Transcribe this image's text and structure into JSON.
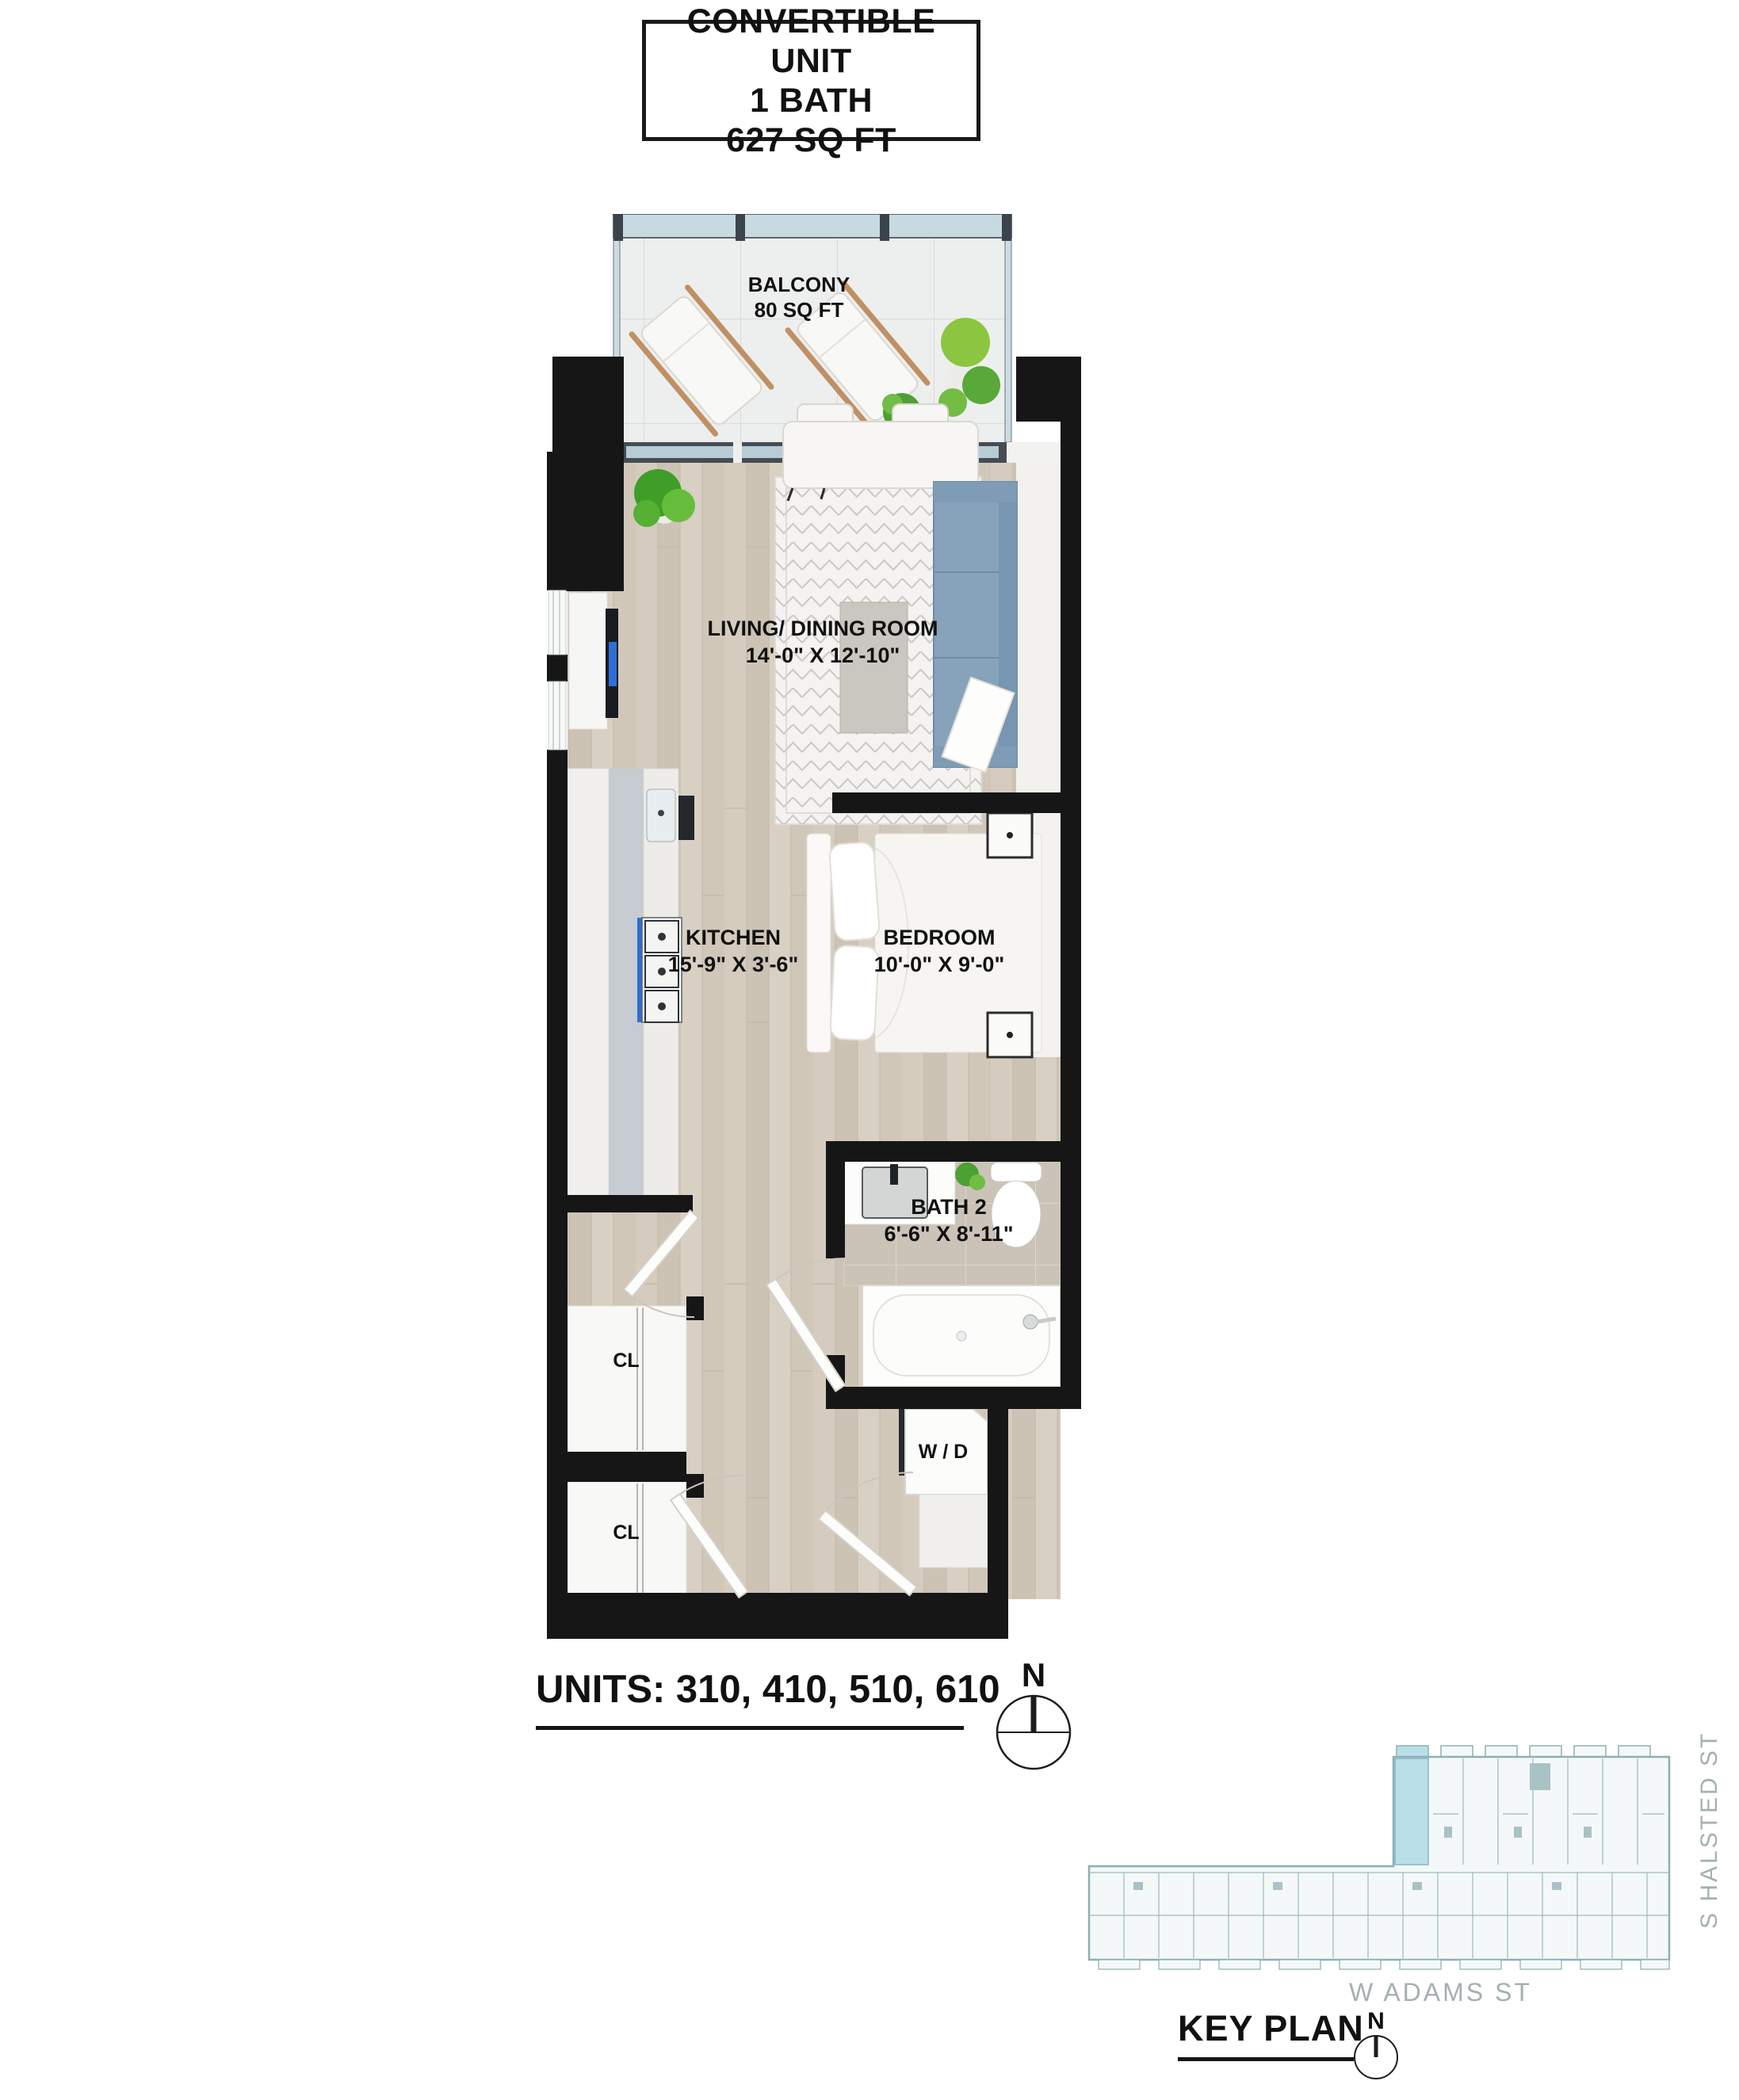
{
  "title_card": {
    "line1": "CONVERTIBLE UNIT",
    "line2": "1 BATH",
    "line3": "627 SQ FT"
  },
  "floor_plan": {
    "balcony": {
      "name": "BALCONY",
      "area": "80 SQ FT"
    },
    "living_dining": {
      "name": "LIVING/ DINING ROOM",
      "dims": "14'-0\" X 12'-10\""
    },
    "kitchen": {
      "name": "KITCHEN",
      "dims": "15'-9\" X 3'-6\""
    },
    "bedroom": {
      "name": "BEDROOM",
      "dims": "10'-0\" X 9'-0\""
    },
    "bath": {
      "name": "BATH 2",
      "dims": "6'-6\" X 8'-11\""
    },
    "closet_upper": {
      "label": "CL"
    },
    "closet_lower": {
      "label": "CL"
    },
    "washer_dryer": {
      "label": "W / D"
    }
  },
  "units_label": "UNITS: 310, 410, 510, 610",
  "compass_main": {
    "label": "N"
  },
  "key_plan": {
    "title": "KEY PLAN",
    "street_south": "W ADAMS ST",
    "street_east": "S HALSTED ST",
    "compass_label": "N",
    "highlight_color": "#b9dfe9"
  },
  "colors": {
    "wall": "#161616",
    "wood_floor": "#d3cabd",
    "bath_tile": "#cbc3b7",
    "sofa": "#87a3bc",
    "tv_screen": "#2f6fd6",
    "balcony_glass": "#c8dae1",
    "key_plan_line": "#8db0b4",
    "street_text": "#a4b0b1"
  }
}
